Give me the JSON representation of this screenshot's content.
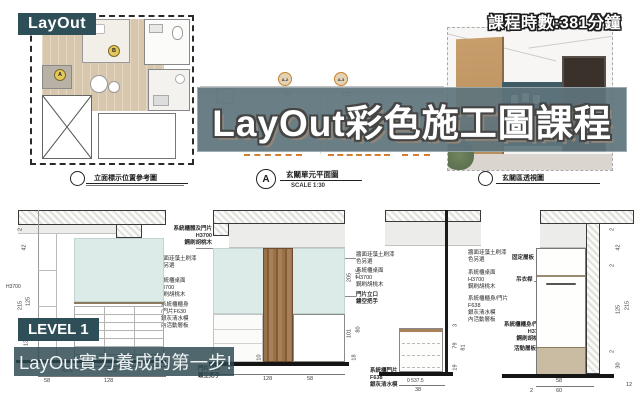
{
  "header": {
    "layout_badge": "LayOut",
    "duration": "課程時數:381分鐘"
  },
  "banner": {
    "title": "LayOut彩色施工圖課程"
  },
  "footer": {
    "level_badge": "LEVEL 1",
    "tagline": "LayOut實力養成的第一步!"
  },
  "captions": {
    "plan_ref": "立面標示位置參考圖",
    "unit_plan_bubble": "A",
    "unit_plan_label": "玄關單元平面圖",
    "unit_plan_scale": "SCALE  1:30",
    "perspective_label": "玄關區透視圖"
  },
  "plan": {
    "marker_a": "A",
    "marker_b": "B"
  },
  "midplan": {
    "marker_a2": "A-2",
    "marker_a3": "A-3",
    "dim1": "58",
    "dim2": "128"
  },
  "elev_a": {
    "dims": {
      "h": "H3700",
      "s1": "2",
      "s2": "42",
      "s3": "125",
      "s4": "215",
      "s5": "130",
      "b1": "42.6",
      "b2": "85.3",
      "b3": "58",
      "b4": "128"
    }
  },
  "elev_b": {
    "dims": {
      "r1": "215",
      "r2": "205",
      "r3": "80",
      "r4": "101",
      "r5": "18",
      "r6": "10",
      "b1": "128",
      "b2": "58"
    }
  },
  "elev_c": {
    "dims": {
      "r1": "3",
      "r2": "79",
      "r3": "81",
      "r4": "19",
      "b1": "0 537.5",
      "b2": "38"
    }
  },
  "elev_d": {
    "dims": {
      "r1": "2",
      "r2": "42",
      "r3": "2",
      "r4": "125",
      "r5": "215",
      "r6": "2",
      "r7": "30",
      "r8": "12",
      "b1": "58",
      "b2": "60",
      "b3": "2"
    }
  },
  "annotations": {
    "a1": "系統櫃體及門片\nH3700\n鋼刷胡桃木",
    "a2": "牆面珪藻土刷漆\n色另選",
    "a3": "系統櫃桌面\nH3700\n鋼刷胡桃木",
    "a4": "系統櫃櫃身\n/門片F630\n銀灰清水模\n內活動層板",
    "a5": "門片立口\n鏤空把手",
    "b1": "牆面珪藻土刷漆\n色另選",
    "b2": "系統櫃桌面\nH3700\n鋼刷胡桃木",
    "b3": "門片立口\n鏤空把手",
    "b4": "系統櫃門片\nF638\n銀灰清水模",
    "d1": "牆面珪藻土刷漆\n色另選",
    "d2": "系統櫃桌面\nH3700\n鋼刷胡桃木",
    "d3": "系統櫃櫃身/門片\nF638\n銀灰清水模\n內活動層板",
    "d4": "固定層板",
    "d5": "吊衣桿",
    "d6": "系統櫃櫃身/門片\nH3700\n鋼刷胡桃木",
    "d7": "活動層板"
  },
  "colors": {
    "accent_teal": "#2e4e58",
    "banner": "#5f747d",
    "marker_orange": "#c8822f",
    "wall_teal": "#dcebe8"
  }
}
